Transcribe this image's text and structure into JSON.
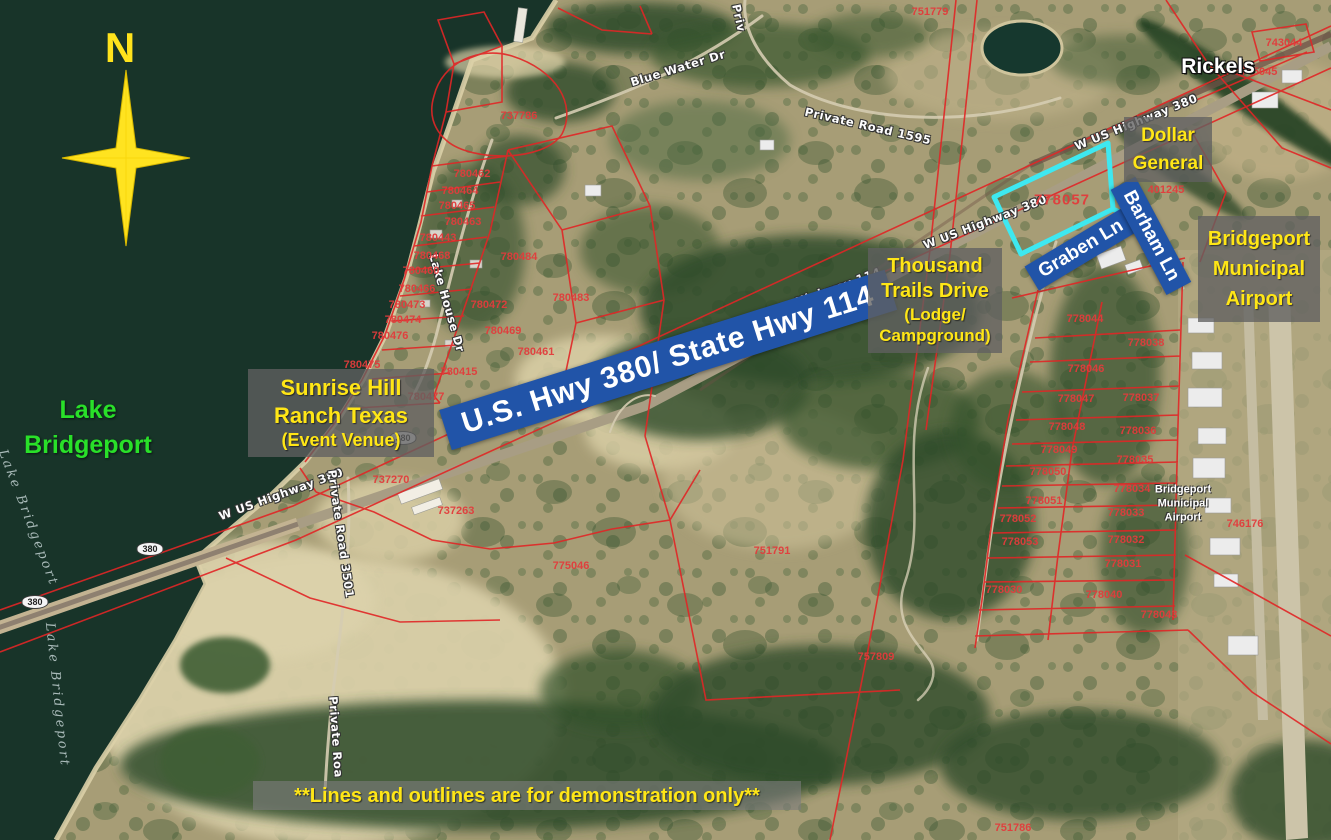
{
  "compass": {
    "label": "N"
  },
  "map_labels": {
    "rickels": "Rickels",
    "lake_green": {
      "line1": "Lake",
      "line2": "Bridgeport"
    },
    "airport_small": {
      "line1": "Bridgeport",
      "line2": "Municipal",
      "line3": "Airport"
    }
  },
  "banners": {
    "highway": "U.S. Hwy 380/ State Hwy 114",
    "graben": "Graben Ln",
    "barham": "Barham Ln"
  },
  "callouts": {
    "dollar": {
      "line1": "Dollar",
      "line2": "General"
    },
    "trails": {
      "line1": "Thousand",
      "line2": "Trails Drive",
      "line3": "(Lodge/",
      "line4": "Campground)"
    },
    "airport": {
      "line1": "Bridgeport",
      "line2": "Municipal",
      "line3": "Airport"
    },
    "sunrise": {
      "line1": "Sunrise Hill",
      "line2": "Ranch Texas",
      "line3": "(Event Venue)"
    },
    "disclaimer": "**Lines and outlines are for demonstration only**"
  },
  "road_labels": [
    {
      "t": "Blue Water Dr",
      "x": 678,
      "y": 68,
      "r": -17
    },
    {
      "t": "Priv",
      "x": 739,
      "y": 18,
      "r": 78
    },
    {
      "t": "Private Road 1595",
      "x": 868,
      "y": 126,
      "r": 13
    },
    {
      "t": "W US Highway 380",
      "x": 1136,
      "y": 122,
      "r": -22
    },
    {
      "t": "W US Highway 380",
      "x": 985,
      "y": 222,
      "r": -21
    },
    {
      "t": "W State Highway 114",
      "x": 810,
      "y": 297,
      "r": -20
    },
    {
      "t": "W US Highway 380",
      "x": 281,
      "y": 494,
      "r": -20
    },
    {
      "t": "Lake House Dr",
      "x": 447,
      "y": 303,
      "r": 74
    },
    {
      "t": "Private Road 3501",
      "x": 341,
      "y": 534,
      "r": 82
    },
    {
      "t": "Private Roa",
      "x": 336,
      "y": 737,
      "r": 86
    }
  ],
  "water_labels": [
    {
      "t": "Lake Bridgeport",
      "x": 28,
      "y": 518,
      "r": 69
    },
    {
      "t": "Lake Bridgeport",
      "x": 57,
      "y": 695,
      "r": 84
    }
  ],
  "shields": [
    {
      "t": "380",
      "x": 150,
      "y": 549
    },
    {
      "t": "380",
      "x": 35,
      "y": 602
    },
    {
      "t": "380",
      "x": 403,
      "y": 438
    }
  ],
  "parcels": [
    {
      "n": "751779",
      "x": 930,
      "y": 12
    },
    {
      "n": "737786",
      "x": 519,
      "y": 116
    },
    {
      "n": "743044",
      "x": 1284,
      "y": 43
    },
    {
      "n": "745045",
      "x": 1259,
      "y": 72
    },
    {
      "n": "401245",
      "x": 1166,
      "y": 190
    },
    {
      "n": "778057",
      "x": 1062,
      "y": 200,
      "big": true
    },
    {
      "n": "780462",
      "x": 472,
      "y": 174
    },
    {
      "n": "780464",
      "x": 460,
      "y": 191
    },
    {
      "n": "780465",
      "x": 457,
      "y": 206
    },
    {
      "n": "780463",
      "x": 463,
      "y": 222
    },
    {
      "n": "780443",
      "x": 438,
      "y": 238
    },
    {
      "n": "780468",
      "x": 432,
      "y": 256
    },
    {
      "n": "780460",
      "x": 421,
      "y": 271
    },
    {
      "n": "780466",
      "x": 417,
      "y": 289
    },
    {
      "n": "780473",
      "x": 407,
      "y": 305
    },
    {
      "n": "780474",
      "x": 403,
      "y": 320
    },
    {
      "n": "780476",
      "x": 390,
      "y": 336
    },
    {
      "n": "780475",
      "x": 362,
      "y": 365
    },
    {
      "n": "780477",
      "x": 426,
      "y": 397
    },
    {
      "n": "780415",
      "x": 459,
      "y": 372
    },
    {
      "n": "780472",
      "x": 489,
      "y": 305
    },
    {
      "n": "780469",
      "x": 503,
      "y": 331
    },
    {
      "n": "780484",
      "x": 519,
      "y": 257
    },
    {
      "n": "780483",
      "x": 571,
      "y": 298
    },
    {
      "n": "780461",
      "x": 536,
      "y": 352
    },
    {
      "n": "737270",
      "x": 391,
      "y": 480
    },
    {
      "n": "737263",
      "x": 456,
      "y": 511
    },
    {
      "n": "775046",
      "x": 571,
      "y": 566
    },
    {
      "n": "751791",
      "x": 772,
      "y": 551
    },
    {
      "n": "757809",
      "x": 876,
      "y": 657
    },
    {
      "n": "751786",
      "x": 1013,
      "y": 828
    },
    {
      "n": "778044",
      "x": 1085,
      "y": 319
    },
    {
      "n": "778038",
      "x": 1146,
      "y": 343
    },
    {
      "n": "778046",
      "x": 1086,
      "y": 369
    },
    {
      "n": "778047",
      "x": 1076,
      "y": 399
    },
    {
      "n": "778037",
      "x": 1141,
      "y": 398
    },
    {
      "n": "778048",
      "x": 1067,
      "y": 427
    },
    {
      "n": "778036",
      "x": 1138,
      "y": 431
    },
    {
      "n": "778049",
      "x": 1059,
      "y": 450
    },
    {
      "n": "778035",
      "x": 1135,
      "y": 460
    },
    {
      "n": "778050",
      "x": 1048,
      "y": 472
    },
    {
      "n": "778034",
      "x": 1132,
      "y": 489
    },
    {
      "n": "778051",
      "x": 1044,
      "y": 501
    },
    {
      "n": "778033",
      "x": 1126,
      "y": 513
    },
    {
      "n": "778052",
      "x": 1018,
      "y": 519
    },
    {
      "n": "778032",
      "x": 1126,
      "y": 540
    },
    {
      "n": "778031",
      "x": 1123,
      "y": 564
    },
    {
      "n": "778053",
      "x": 1020,
      "y": 542
    },
    {
      "n": "778030",
      "x": 1004,
      "y": 590
    },
    {
      "n": "778040",
      "x": 1104,
      "y": 595
    },
    {
      "n": "778043",
      "x": 1159,
      "y": 615
    },
    {
      "n": "746176",
      "x": 1245,
      "y": 524
    }
  ],
  "colors": {
    "water": "#183429",
    "parcel_line": "#e12626",
    "parcel_text": "#e23c3c",
    "highlight_outline": "#3ee8f0",
    "banner_blue": "#2154a8",
    "callout_bg_grey": "#606060",
    "callout_text_yellow": "#ffe616",
    "lake_label_green": "#29e029",
    "compass_yellow": "#ffe31c"
  }
}
